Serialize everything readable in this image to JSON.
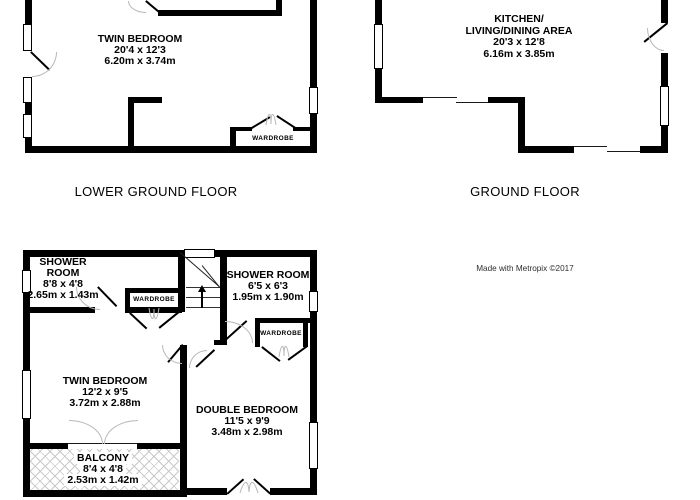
{
  "credit": "Made with Metropix ©2017",
  "lower_ground": {
    "floor_label": "LOWER GROUND FLOOR",
    "room": {
      "name": "TWIN BEDROOM",
      "imperial": "20'4 x 12'3",
      "metric": "6.20m x 3.74m"
    },
    "wardrobe_label": "WARDROBE"
  },
  "ground": {
    "floor_label": "GROUND FLOOR",
    "room": {
      "name_line1": "KITCHEN/",
      "name_line2": "LIVING/DINING AREA",
      "imperial": "20'3 x 12'8",
      "metric": "6.16m x 3.85m"
    }
  },
  "first": {
    "shower_left": {
      "name_line1": "SHOWER",
      "name_line2": "ROOM",
      "imperial": "8'8 x 4'8",
      "metric": "2.65m x 1.43m"
    },
    "shower_right": {
      "name": "SHOWER ROOM",
      "imperial": "6'5 x 6'3",
      "metric": "1.95m x 1.90m"
    },
    "twin": {
      "name": "TWIN BEDROOM",
      "imperial": "12'2 x 9'5",
      "metric": "3.72m x 2.88m"
    },
    "double": {
      "name": "DOUBLE BEDROOM",
      "imperial": "11'5 x 9'9",
      "metric": "3.48m x 2.98m"
    },
    "balcony": {
      "name": "BALCONY",
      "imperial": "8'4 x 4'8",
      "metric": "2.53m x 1.42m"
    },
    "wardrobe_left_label": "WARDROBE",
    "wardrobe_right_label": "WARDROBE"
  },
  "colors": {
    "wall": "#000000",
    "door_arc": "#b8b8b8",
    "hatch_line": "#c9c9c9"
  }
}
